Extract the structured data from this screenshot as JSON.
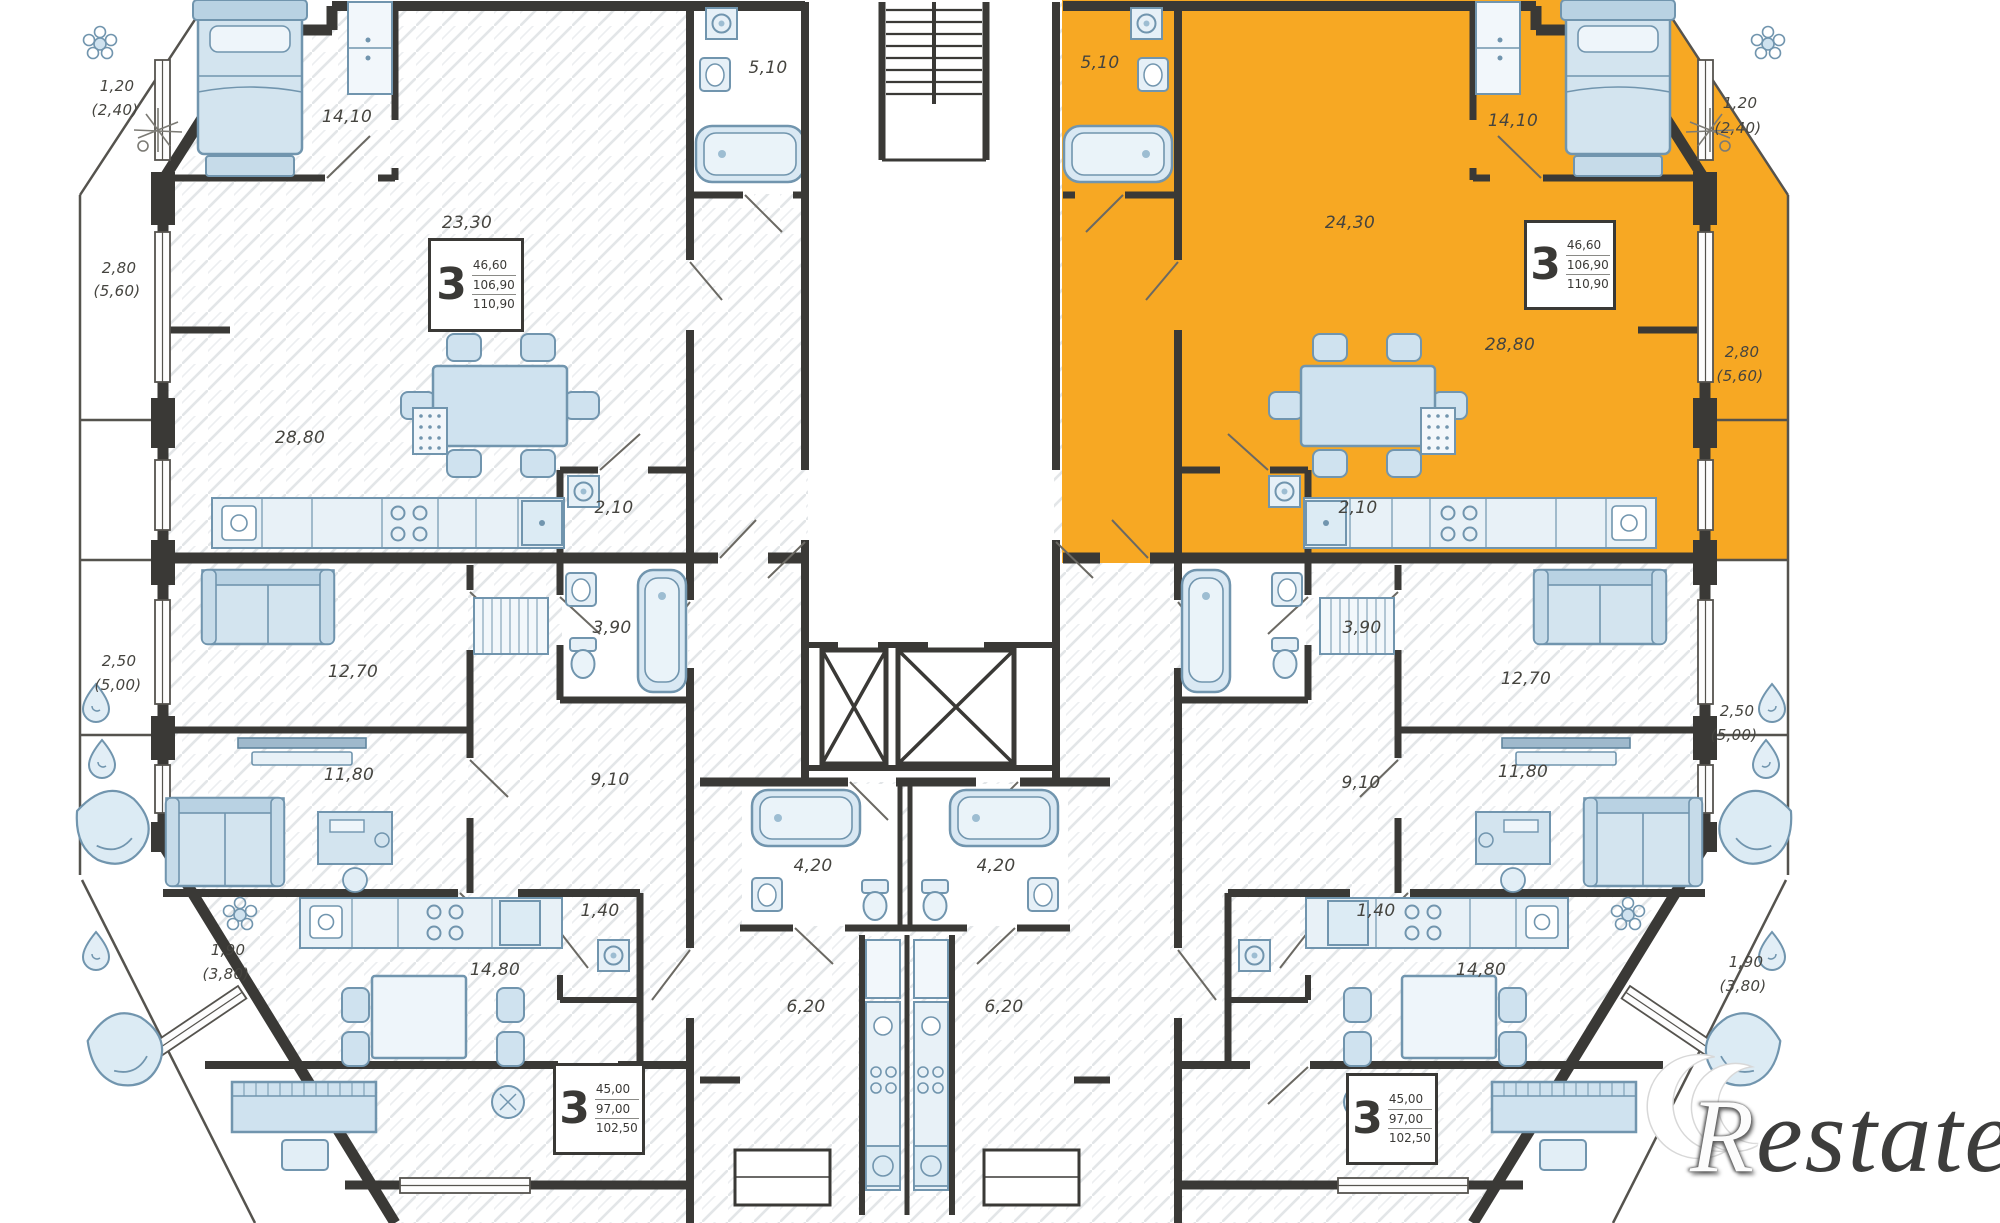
{
  "plan": {
    "title": "residential-floor-plan",
    "highlight_color": "#f7a823",
    "wall_color": "#3a3936",
    "furniture_color": "#d3e4ef",
    "watermark": {
      "prefix": "R",
      "suffix": "estate"
    },
    "info_boxes": {
      "top_left": {
        "rooms": "3",
        "area1": "46,60",
        "area2": "106,90",
        "area3": "110,90"
      },
      "top_right": {
        "rooms": "3",
        "area1": "46,60",
        "area2": "106,90",
        "area3": "110,90"
      },
      "bottom_left": {
        "rooms": "3",
        "area1": "45,00",
        "area2": "97,00",
        "area3": "102,50"
      },
      "bottom_right": {
        "rooms": "3",
        "area1": "45,00",
        "area2": "97,00",
        "area3": "102,50"
      }
    },
    "labels": {
      "tl_bath": "5,10",
      "tl_bedroom": "14,10",
      "tl_living": "23,30",
      "tl_balc1a": "1,20",
      "tl_balc1b": "(2,40)",
      "tl_balc2a": "2,80",
      "tl_balc2b": "(5,60)",
      "tl_kitchen": "28,80",
      "tl_wc": "2,10",
      "tl_bath2": "3,90",
      "bl_balc3a": "2,50",
      "bl_balc3b": "(5,00)",
      "bl_room1": "12,70",
      "bl_room2": "11,80",
      "bl_hall": "9,10",
      "bl_kitchen": "14,80",
      "bl_wc": "1,40",
      "bl_balc4a": "1,90",
      "bl_balc4b": "(3,80)",
      "c_bath_l": "4,20",
      "c_bath_r": "4,20",
      "c_hall_l": "6,20",
      "c_hall_r": "6,20",
      "tr_bath": "5,10",
      "tr_hall": "24,30",
      "tr_bedroom": "14,10",
      "tr_balc1a": "1,20",
      "tr_balc1b": "(2,40)",
      "tr_kitchen": "28,80",
      "tr_balc2a": "2,80",
      "tr_balc2b": "(5,60)",
      "tr_wc": "2,10",
      "tr_bath2": "3,90",
      "br_room1": "12,70",
      "br_room2": "11,80",
      "br_hall": "9,10",
      "br_balc3a": "2,50",
      "br_balc3b": "(5,00)",
      "br_kitchen": "14,80",
      "br_wc": "1,40",
      "br_balc4a": "1,90",
      "br_balc4b": "(3,80)"
    }
  }
}
